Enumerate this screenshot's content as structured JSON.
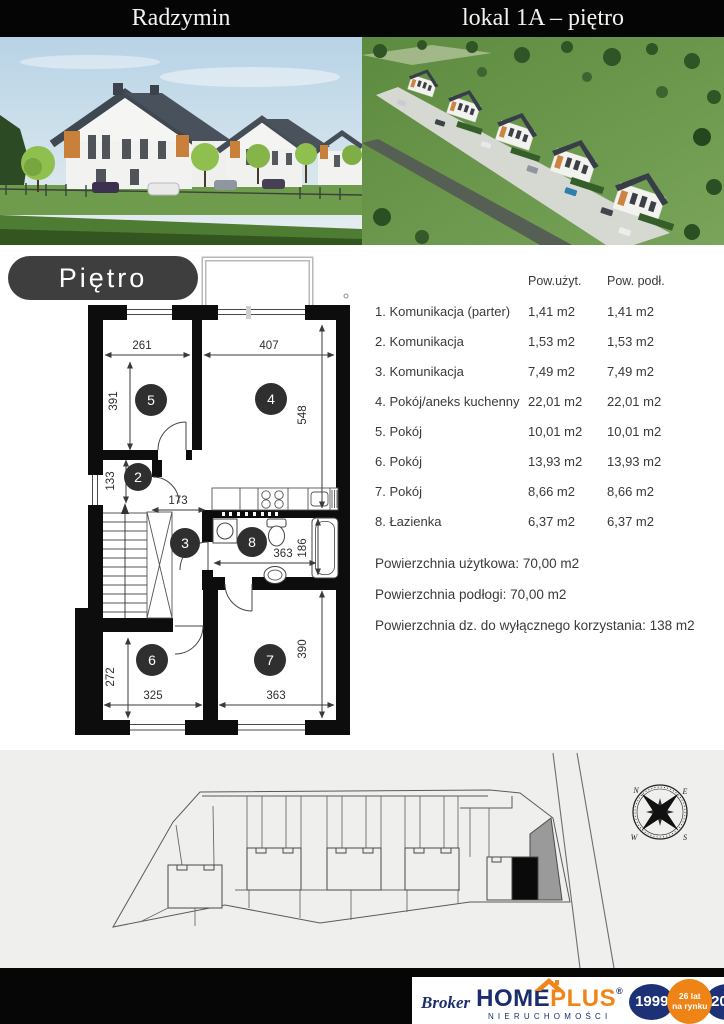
{
  "header": {
    "location": "Radzymin",
    "unit": "lokal 1A – piętro"
  },
  "floor_plan": {
    "pill_label": "Piętro",
    "rooms": {
      "r2": "2",
      "r3": "3",
      "r4": "4",
      "r5": "5",
      "r6": "6",
      "r7": "7",
      "r8": "8"
    },
    "dims": {
      "w5": "261",
      "w4": "407",
      "h5": "391",
      "h4": "548",
      "h2": "133",
      "w3": "173",
      "w8": "363",
      "h8": "186",
      "h6": "272",
      "w6": "325",
      "h7": "390",
      "w7": "363"
    }
  },
  "table": {
    "col_uzyt": "Pow.użyt.",
    "col_podl": "Pow. podł.",
    "rows": [
      {
        "name": "1. Komunikacja (parter)",
        "uzyt": "1,41 m2",
        "podl": "1,41 m2"
      },
      {
        "name": "2. Komunikacja",
        "uzyt": "1,53 m2",
        "podl": "1,53 m2"
      },
      {
        "name": "3. Komunikacja",
        "uzyt": "7,49 m2",
        "podl": "7,49 m2"
      },
      {
        "name": "4. Pokój/aneks kuchenny",
        "uzyt": "22,01 m2",
        "podl": "22,01 m2"
      },
      {
        "name": "5. Pokój",
        "uzyt": "10,01 m2",
        "podl": "10,01 m2"
      },
      {
        "name": "6. Pokój",
        "uzyt": "13,93 m2",
        "podl": "13,93 m2"
      },
      {
        "name": "7. Pokój",
        "uzyt": "8,66 m2",
        "podl": "8,66 m2"
      },
      {
        "name": "8. Łazienka",
        "uzyt": "6,37 m2",
        "podl": "6,37 m2"
      }
    ],
    "summary": [
      "Powierzchnia użytkowa: 70,00 m2",
      "Powierzchnia podłogi: 70,00 m2",
      "Powierzchnia dz. do wyłącznego korzystania: 138 m2"
    ]
  },
  "site_plan": {
    "compass": {
      "n": "N",
      "e": "E",
      "s": "S",
      "w": "W"
    }
  },
  "footer": {
    "broker": "Broker",
    "brand_home": "HOME",
    "brand_plus": "PLUS",
    "registered": "®",
    "subtitle": "NIERUCHOMOŚCI",
    "year_founded": "1999",
    "badge_line1": "26 lat",
    "badge_line2": "na rynku",
    "year_current": "2025"
  },
  "colors": {
    "accent_orange": "#f08519",
    "brand_navy": "#1c2d6e",
    "wall_black": "#0d0d0d",
    "pill_gray": "#3e3e3e",
    "site_bg": "#efefee"
  }
}
